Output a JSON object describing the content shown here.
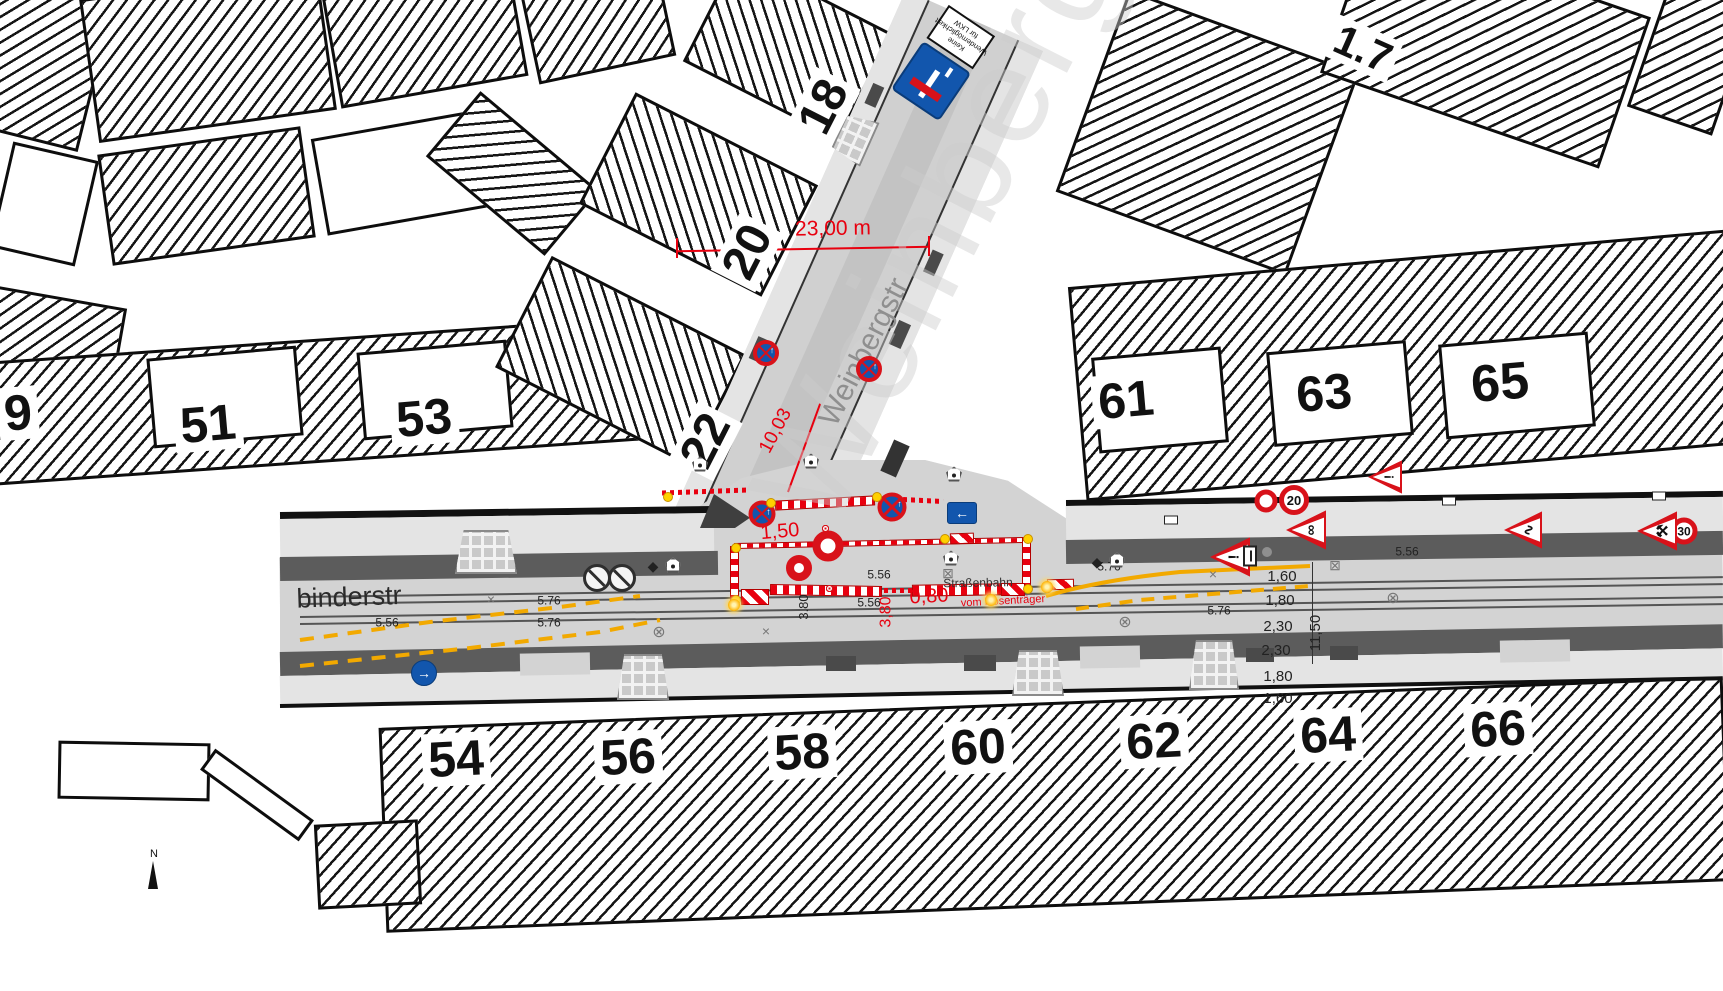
{
  "colors": {
    "red": "#e8000f",
    "sign_red": "#d8121a",
    "sign_blue": "#1256ad",
    "marking_yellow": "#f2a900",
    "road": "#d3d3d3",
    "sidewalk_band": "#5c5c5c"
  },
  "north": {
    "label": "N"
  },
  "labels": [
    {
      "n": "parcel-number",
      "t": "9",
      "x": 18,
      "y": 413,
      "r": -5,
      "s": 50,
      "b": 1,
      "bg": 1
    },
    {
      "n": "parcel-number",
      "t": "51",
      "x": 208,
      "y": 424,
      "r": -5,
      "s": 50,
      "b": 1,
      "bg": 1
    },
    {
      "n": "parcel-number",
      "t": "53",
      "x": 424,
      "y": 418,
      "r": -5,
      "s": 50,
      "b": 1,
      "bg": 1
    },
    {
      "n": "parcel-number",
      "t": "22",
      "x": 706,
      "y": 441,
      "r": -63,
      "s": 48,
      "b": 1,
      "bg": 1
    },
    {
      "n": "parcel-number",
      "t": "20",
      "x": 748,
      "y": 252,
      "r": -63,
      "s": 48,
      "b": 1,
      "bg": 1
    },
    {
      "n": "parcel-number",
      "t": "18",
      "x": 824,
      "y": 107,
      "r": -63,
      "s": 48,
      "b": 1,
      "bg": 1
    },
    {
      "n": "parcel-number",
      "t": "61",
      "x": 1126,
      "y": 400,
      "r": -5,
      "s": 50,
      "b": 1,
      "bg": 1
    },
    {
      "n": "parcel-number",
      "t": "63",
      "x": 1324,
      "y": 393,
      "r": -5,
      "s": 50,
      "b": 1,
      "bg": 1
    },
    {
      "n": "parcel-number",
      "t": "65",
      "x": 1500,
      "y": 383,
      "r": -5,
      "s": 52,
      "b": 1,
      "bg": 1
    },
    {
      "n": "parcel-number",
      "t": "1.7",
      "x": 1363,
      "y": 49,
      "r": 24,
      "s": 42,
      "b": 1,
      "bg": 1
    },
    {
      "n": "parcel-number",
      "t": "54",
      "x": 456,
      "y": 759,
      "r": -3,
      "s": 50,
      "b": 1,
      "bg": 1
    },
    {
      "n": "parcel-number",
      "t": "56",
      "x": 628,
      "y": 757,
      "r": -3,
      "s": 50,
      "b": 1,
      "bg": 1
    },
    {
      "n": "parcel-number",
      "t": "58",
      "x": 802,
      "y": 752,
      "r": -3,
      "s": 50,
      "b": 1,
      "bg": 1
    },
    {
      "n": "parcel-number",
      "t": "60",
      "x": 978,
      "y": 747,
      "r": -3,
      "s": 50,
      "b": 1,
      "bg": 1
    },
    {
      "n": "parcel-number",
      "t": "62",
      "x": 1154,
      "y": 741,
      "r": -3,
      "s": 50,
      "b": 1,
      "bg": 1
    },
    {
      "n": "parcel-number",
      "t": "64",
      "x": 1328,
      "y": 735,
      "r": -3,
      "s": 50,
      "b": 1,
      "bg": 1
    },
    {
      "n": "parcel-number",
      "t": "66",
      "x": 1498,
      "y": 729,
      "r": -3,
      "s": 50,
      "b": 1,
      "bg": 1
    },
    {
      "n": "street-name-watermark",
      "t": "Weinberg",
      "x": 935,
      "y": 225,
      "r": -63,
      "s": 140,
      "c": "#cdcdcd",
      "o": 0.45,
      "ls": 6
    },
    {
      "n": "street-name",
      "t": "Weinbergstr",
      "x": 864,
      "y": 352,
      "r": -63,
      "s": 30,
      "c": "#8f8f8f"
    },
    {
      "n": "street-name",
      "t": "binderstr",
      "x": 349,
      "y": 597,
      "r": -2,
      "s": 27,
      "c": "#2b2b2b"
    },
    {
      "n": "tram-label",
      "t": "Straßenbahn",
      "x": 978,
      "y": 583,
      "r": -1,
      "s": 12,
      "c": "#333333"
    },
    {
      "n": "dimension-label-red",
      "t": "23,00 m",
      "x": 833,
      "y": 229,
      "r": -1,
      "s": 21,
      "c": "#e8000f"
    },
    {
      "n": "dimension-label-red",
      "t": "1,50",
      "x": 780,
      "y": 532,
      "r": -5,
      "s": 20,
      "c": "#e8000f"
    },
    {
      "n": "dimension-label-red",
      "t": "10,03",
      "x": 776,
      "y": 431,
      "r": -62,
      "s": 19,
      "c": "#e8000f"
    },
    {
      "n": "dimension-label-red",
      "t": "0,80",
      "x": 929,
      "y": 597,
      "r": -3,
      "s": 20,
      "c": "#e8000f"
    },
    {
      "n": "dimension-label-red",
      "t": "vom Hosenträger",
      "x": 1003,
      "y": 602,
      "r": -3,
      "s": 11,
      "c": "#e8000f"
    },
    {
      "n": "dimension-label-red",
      "t": "3,80",
      "x": 887,
      "y": 612,
      "r": -90,
      "s": 16,
      "c": "#e8000f"
    },
    {
      "n": "measure-label",
      "t": "5.56",
      "x": 387,
      "y": 623,
      "r": 0,
      "s": 12,
      "c": "#222222"
    },
    {
      "n": "measure-label",
      "t": "5.76",
      "x": 549,
      "y": 601,
      "r": 0,
      "s": 12,
      "c": "#222222"
    },
    {
      "n": "measure-label",
      "t": "5.76",
      "x": 549,
      "y": 623,
      "r": 0,
      "s": 12,
      "c": "#222222"
    },
    {
      "n": "measure-label",
      "t": "5.56",
      "x": 879,
      "y": 575,
      "r": 0,
      "s": 12,
      "c": "#222222"
    },
    {
      "n": "measure-label",
      "t": "5.56",
      "x": 869,
      "y": 603,
      "r": 0,
      "s": 12,
      "c": "#222222"
    },
    {
      "n": "measure-label",
      "t": "5.76",
      "x": 1109,
      "y": 567,
      "r": 0,
      "s": 12,
      "c": "#222222"
    },
    {
      "n": "measure-label",
      "t": "5.76",
      "x": 1219,
      "y": 611,
      "r": 0,
      "s": 12,
      "c": "#222222"
    },
    {
      "n": "measure-label",
      "t": "5.56",
      "x": 1407,
      "y": 552,
      "r": 0,
      "s": 12,
      "c": "#222222"
    },
    {
      "n": "measure-label",
      "t": "3.80",
      "x": 804,
      "y": 607,
      "r": -90,
      "s": 13,
      "c": "#222222"
    },
    {
      "n": "cross-section-measure",
      "t": "1,60",
      "x": 1282,
      "y": 577,
      "r": 0,
      "s": 15,
      "c": "#222222"
    },
    {
      "n": "cross-section-measure",
      "t": "1,80",
      "x": 1280,
      "y": 601,
      "r": 0,
      "s": 15,
      "c": "#222222"
    },
    {
      "n": "cross-section-measure",
      "t": "2,30",
      "x": 1278,
      "y": 627,
      "r": 0,
      "s": 15,
      "c": "#222222"
    },
    {
      "n": "cross-section-measure",
      "t": "2,30",
      "x": 1276,
      "y": 651,
      "r": 0,
      "s": 15,
      "c": "#222222"
    },
    {
      "n": "cross-section-measure",
      "t": "1,80",
      "x": 1278,
      "y": 677,
      "r": 0,
      "s": 15,
      "c": "#222222"
    },
    {
      "n": "cross-section-measure",
      "t": "1,60",
      "x": 1278,
      "y": 699,
      "r": 0,
      "s": 15,
      "c": "#222222"
    },
    {
      "n": "cross-section-measure",
      "t": "11,50",
      "x": 1316,
      "y": 633,
      "r": -90,
      "s": 15,
      "c": "#222222"
    }
  ],
  "signs": [
    {
      "type": "deadend",
      "meaning": "Sackgasse mit Zusatz",
      "x": 944,
      "y": 62,
      "r": 214,
      "supp": "Keine\nWendemöglichkeit\nfür LKW"
    },
    {
      "type": "nostop",
      "meaning": "Absolutes Haltverbot",
      "x": 766,
      "y": 353,
      "d": 26
    },
    {
      "type": "nostop",
      "meaning": "Absolutes Haltverbot",
      "x": 869,
      "y": 369,
      "d": 26
    },
    {
      "type": "nostop",
      "meaning": "Absolutes Haltverbot",
      "x": 762,
      "y": 514,
      "d": 27
    },
    {
      "type": "nostop",
      "meaning": "Absolutes Haltverbot",
      "x": 892,
      "y": 507,
      "d": 29
    },
    {
      "type": "noveh",
      "meaning": "Verbot für Fahrzeuge aller Art",
      "x": 828,
      "y": 546,
      "d": 31
    },
    {
      "type": "noveh",
      "meaning": "Verbot für Fahrzeuge aller Art",
      "x": 799,
      "y": 568,
      "d": 26
    },
    {
      "type": "ring",
      "meaning": "Verbotszeichen",
      "x": 1266,
      "y": 501,
      "d": 23
    },
    {
      "type": "speed",
      "label": "20",
      "x": 1294,
      "y": 500,
      "d": 30
    },
    {
      "type": "speed",
      "label": "30",
      "x": 1684,
      "y": 531,
      "d": 27
    },
    {
      "type": "warn",
      "glyph": "!",
      "meaning": "Gefahrstelle",
      "x": 1230,
      "y": 557,
      "s": 40
    },
    {
      "type": "warn",
      "glyph": "!",
      "meaning": "Gefahrstelle",
      "x": 1385,
      "y": 477,
      "s": 34
    },
    {
      "type": "warn",
      "glyph": "∞",
      "meaning": "Radverkehr",
      "x": 1306,
      "y": 530,
      "s": 40
    },
    {
      "type": "warn",
      "glyph": "∿",
      "meaning": "Unebene Fahrbahn",
      "x": 1523,
      "y": 530,
      "s": 38
    },
    {
      "type": "warn",
      "glyph": "⚒",
      "meaning": "Arbeitsstelle",
      "x": 1657,
      "y": 531,
      "s": 40
    },
    {
      "type": "barrow",
      "glyph": "←",
      "shape": "rect",
      "meaning": "Vorbeifahrt links",
      "x": 962,
      "y": 513,
      "w": 30,
      "h": 22
    },
    {
      "type": "barrow",
      "glyph": "→",
      "shape": "circle",
      "meaning": "Fahrtrichtung rechts",
      "x": 424,
      "y": 673,
      "d": 26
    },
    {
      "type": "graypark",
      "meaning": "Haltverbot (Bestand)",
      "x": 597,
      "y": 578,
      "d": 28
    },
    {
      "type": "graypark",
      "meaning": "Haltverbot (Bestand)",
      "x": 622,
      "y": 578,
      "d": 28
    },
    {
      "type": "smallplate",
      "meaning": "Hinweisschild",
      "x": 1250,
      "y": 556
    }
  ],
  "symbols": [
    {
      "type": "pent",
      "x": 700,
      "y": 464
    },
    {
      "type": "pent",
      "x": 811,
      "y": 461
    },
    {
      "type": "pent",
      "x": 954,
      "y": 474
    },
    {
      "type": "pent",
      "x": 951,
      "y": 558
    },
    {
      "type": "pent",
      "x": 673,
      "y": 565
    },
    {
      "type": "pent",
      "x": 1117,
      "y": 560
    },
    {
      "type": "diamond",
      "x": 653,
      "y": 566
    },
    {
      "type": "diamond",
      "x": 1097,
      "y": 562
    },
    {
      "type": "xmark",
      "x": 491,
      "y": 599
    },
    {
      "type": "xmark",
      "x": 766,
      "y": 631
    },
    {
      "type": "xmark",
      "x": 1213,
      "y": 574
    },
    {
      "type": "circlex",
      "x": 659,
      "y": 633
    },
    {
      "type": "circlex",
      "x": 1125,
      "y": 623
    },
    {
      "type": "circlex",
      "x": 1393,
      "y": 599
    },
    {
      "type": "boxx",
      "x": 948,
      "y": 573
    },
    {
      "type": "boxx",
      "x": 1335,
      "y": 565
    },
    {
      "type": "lamp",
      "x": 771,
      "y": 503
    },
    {
      "type": "lamp",
      "x": 877,
      "y": 497
    },
    {
      "type": "lamp",
      "x": 736,
      "y": 548
    },
    {
      "type": "lamp",
      "x": 736,
      "y": 600
    },
    {
      "type": "lamp",
      "x": 1028,
      "y": 539
    },
    {
      "type": "lamp",
      "x": 1028,
      "y": 589
    },
    {
      "type": "lamp",
      "x": 668,
      "y": 497
    },
    {
      "type": "lamp",
      "x": 945,
      "y": 539
    },
    {
      "type": "star",
      "x": 734,
      "y": 605
    },
    {
      "type": "star",
      "x": 991,
      "y": 600
    },
    {
      "type": "star",
      "x": 1047,
      "y": 587
    },
    {
      "type": "feet",
      "x": 822,
      "y": 525,
      "count": 5
    },
    {
      "type": "feet",
      "x": 826,
      "y": 585,
      "count": 7
    },
    {
      "type": "whitebox",
      "x": 1449,
      "y": 501
    },
    {
      "type": "whitebox",
      "x": 1659,
      "y": 496
    },
    {
      "type": "whitebox",
      "x": 1171,
      "y": 520
    },
    {
      "type": "graydot",
      "x": 1267,
      "y": 552
    }
  ],
  "symbol_glyphs": {
    "diamond": "◆",
    "xmark": "×",
    "circlex": "⊗",
    "boxx": "⊠",
    "nostop_arrow": "↑"
  }
}
